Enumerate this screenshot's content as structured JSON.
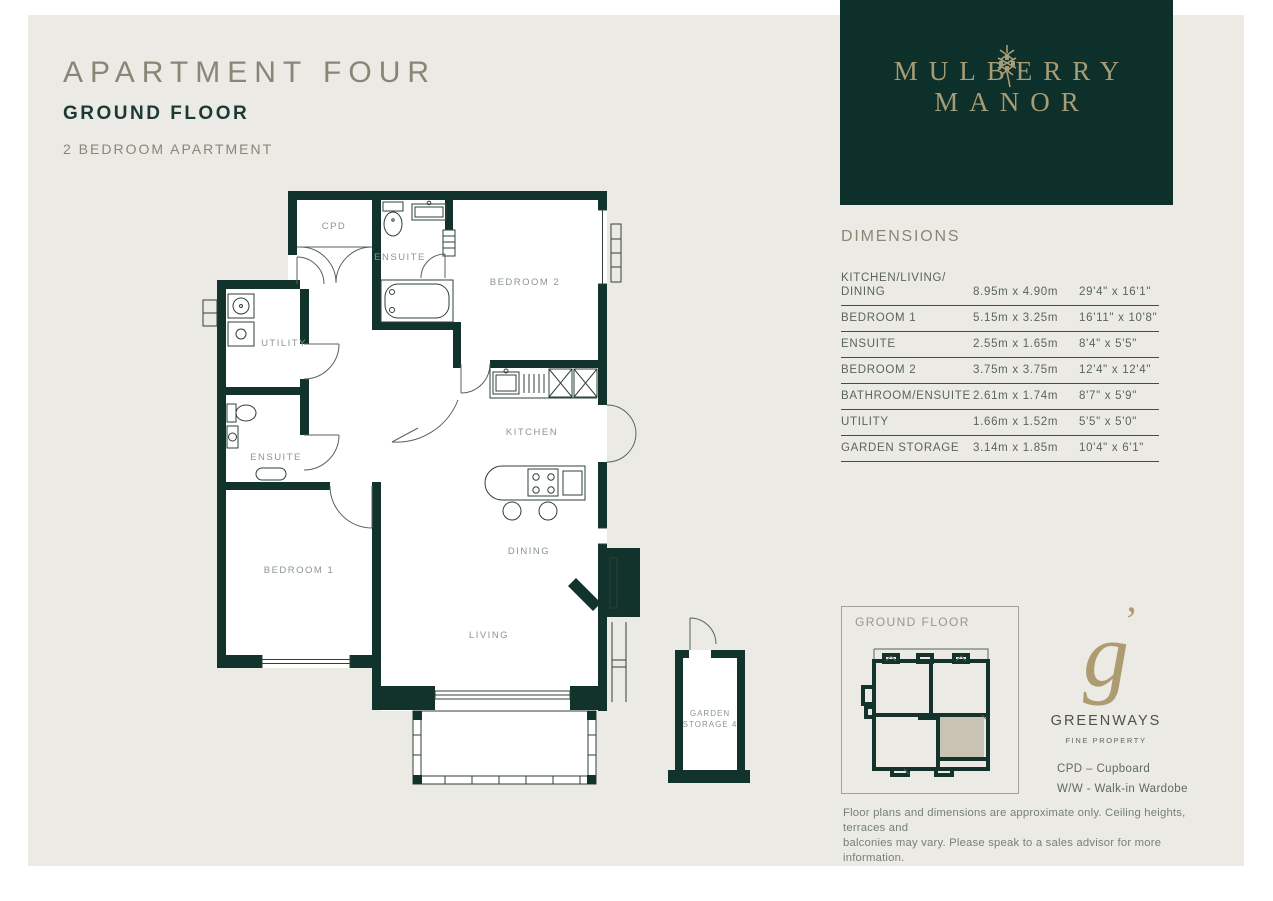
{
  "header": {
    "title": "APARTMENT FOUR",
    "floor": "GROUND FLOOR",
    "type": "2 BEDROOM APARTMENT"
  },
  "brand": {
    "line1": "MULBERRY",
    "line2": "MANOR",
    "panel_color": "#0D302A",
    "gold_color": "#A89C76"
  },
  "dimensions": {
    "heading": "DIMENSIONS",
    "rows": [
      {
        "room": "KITCHEN/LIVING/ DINING",
        "metric": "8.95m x 4.90m",
        "imperial": "29'4\" x 16'1\""
      },
      {
        "room": "BEDROOM 1",
        "metric": "5.15m x 3.25m",
        "imperial": "16'11\" x 10'8\""
      },
      {
        "room": "ENSUITE",
        "metric": "2.55m x 1.65m",
        "imperial": "8'4\" x 5'5\""
      },
      {
        "room": "BEDROOM 2",
        "metric": "3.75m x 3.75m",
        "imperial": "12'4\" x 12'4\""
      },
      {
        "room": "BATHROOM/ENSUITE",
        "metric": "2.61m x 1.74m",
        "imperial": "8'7\" x 5'9\""
      },
      {
        "room": "UTILITY",
        "metric": "1.66m x 1.52m",
        "imperial": "5'5\" x 5'0\""
      },
      {
        "room": "GARDEN STORAGE",
        "metric": "3.14m x 1.85m",
        "imperial": "10'4\" x 6'1\""
      }
    ]
  },
  "floor_plan": {
    "wall_color": "#11332C",
    "labels": {
      "cpd": "CPD",
      "ensuite_top": "ENSUITE",
      "bedroom2": "BEDROOM 2",
      "utility": "UTILITY",
      "ensuite_left": "ENSUITE",
      "kitchen": "KITCHEN",
      "dining": "DINING",
      "living": "LIVING",
      "bedroom1": "BEDROOM 1",
      "garden_storage_line1": "GARDEN",
      "garden_storage_line2": "STORAGE 4"
    }
  },
  "key_plan": {
    "label": "GROUND FLOOR",
    "highlight_color": "#C9C3B4"
  },
  "agent": {
    "monogram": "g",
    "monogram_ear": "’",
    "name": "GREENWAYS",
    "tagline": "FINE PROPERTY"
  },
  "legend": {
    "items": [
      "CPD – Cupboard",
      "W/W - Walk-in Wardobe"
    ]
  },
  "disclaimer": {
    "lines": [
      "Floor plans and dimensions are approximate only. Ceiling heights, terraces and",
      "balconies may vary. Please speak to a sales advisor for more information."
    ]
  }
}
